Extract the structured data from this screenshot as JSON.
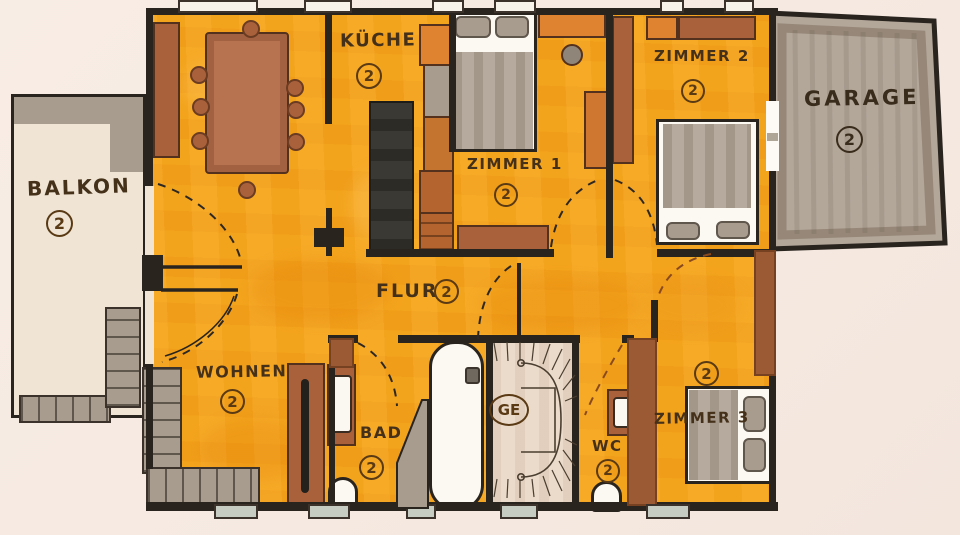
{
  "plan": {
    "rooms": [
      {
        "name": "balkon",
        "label": "BALKON",
        "level_badge": "2"
      },
      {
        "name": "kueche",
        "label": "KÜCHE",
        "level_badge": "2"
      },
      {
        "name": "zimmer1",
        "label": "ZIMMER 1",
        "level_badge": "2"
      },
      {
        "name": "zimmer2",
        "label": "ZIMMER 2",
        "level_badge": "2"
      },
      {
        "name": "garage",
        "label": "GARAGE",
        "level_badge": "2"
      },
      {
        "name": "flur",
        "label": "FLUR",
        "level_badge": "2"
      },
      {
        "name": "wohnen",
        "label": "WOHNEN",
        "level_badge": "2"
      },
      {
        "name": "bad",
        "label": "BAD",
        "level_badge": "2"
      },
      {
        "name": "treppe",
        "label": "GE"
      },
      {
        "name": "wc",
        "label": "WC",
        "level_badge": "2"
      },
      {
        "name": "zimmer3",
        "label": "ZIMMER 3",
        "level_badge": "2"
      }
    ],
    "colors": {
      "paper": "#f7ece4",
      "floor_orange": "#f3a41d",
      "wall_dark": "#2a241f",
      "furniture_brown": "#a9613b",
      "appliance_gray": "#a89c8e",
      "stair_floor": "#ebdbca",
      "balcony_floor": "#f0e5d5",
      "garage_fill": "#b3a79a",
      "ink": "#45301a"
    }
  }
}
